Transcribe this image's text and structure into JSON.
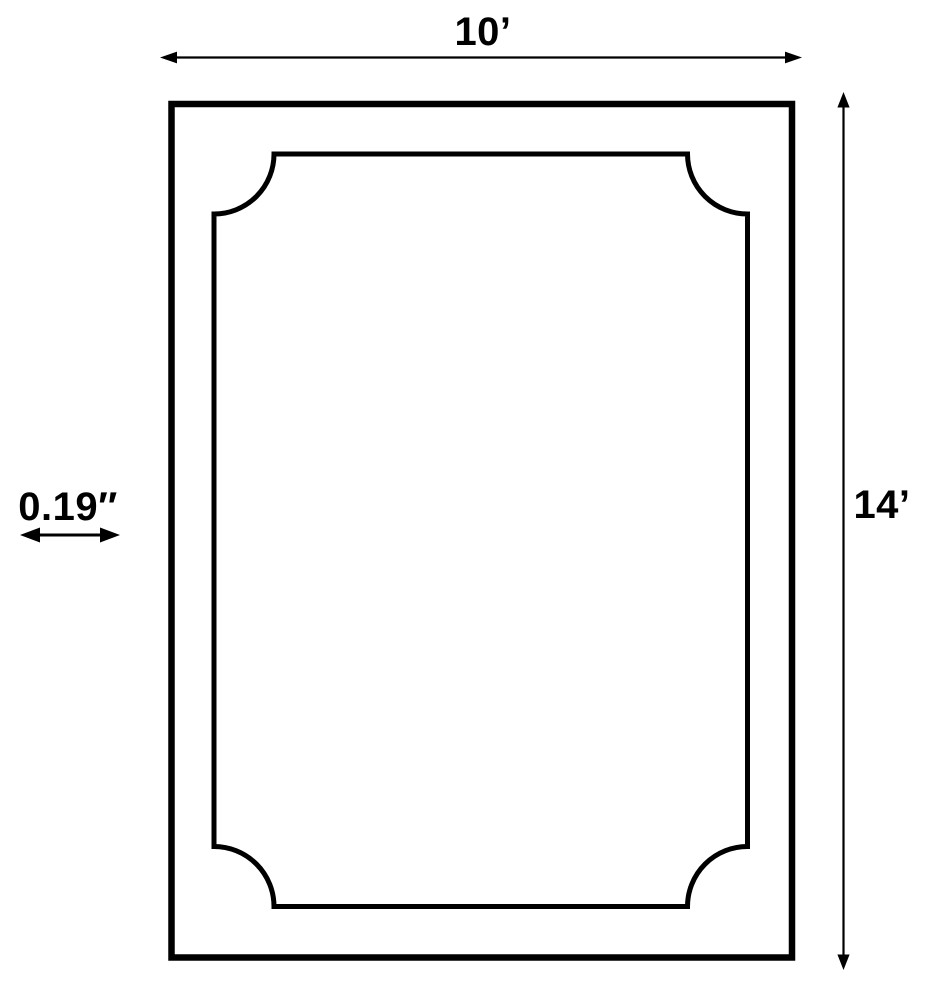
{
  "diagram": {
    "type": "dimension-diagram",
    "subject": "rectangle-with-scalloped-inner-border",
    "labels": {
      "width": "10’",
      "height": "14’",
      "thickness": "0.19″"
    },
    "colors": {
      "line": "#000000",
      "text": "#000000",
      "background": "#ffffff"
    }
  }
}
